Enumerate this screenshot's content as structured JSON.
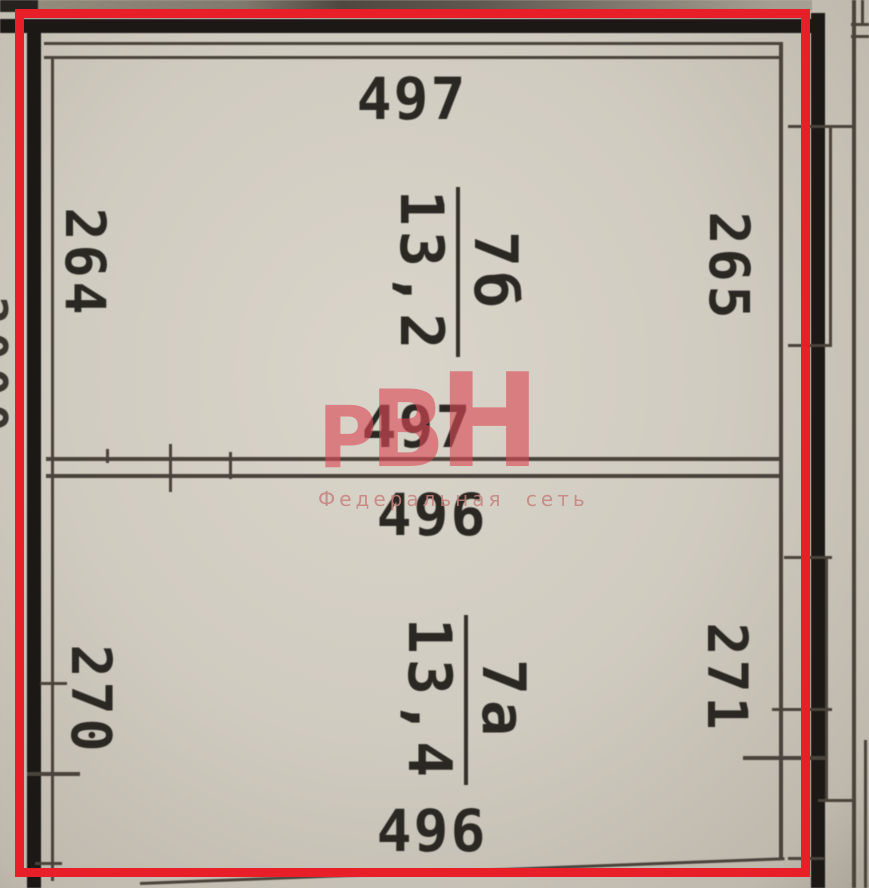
{
  "plan": {
    "rooms": [
      {
        "number": "7б",
        "area": "13,2",
        "width_top": "497",
        "width_bottom": "497",
        "height_left": "264",
        "height_right": "265"
      },
      {
        "number": "7а",
        "area": "13,4",
        "width_top": "496",
        "width_bottom": "496",
        "height_left": "270",
        "height_right": "271"
      }
    ],
    "edge_dimension_partial": "2000"
  },
  "watermark": {
    "logo_letters": [
      "Р",
      "В",
      "Н"
    ],
    "tagline": "Федеральная сеть"
  },
  "colors": {
    "highlight_frame": "#e81e28",
    "wall": "#1b1815",
    "thin_line": "#49433b",
    "paper": "#cfcabf",
    "watermark_red": "#db4856",
    "dimension_text": "#2b2722"
  }
}
